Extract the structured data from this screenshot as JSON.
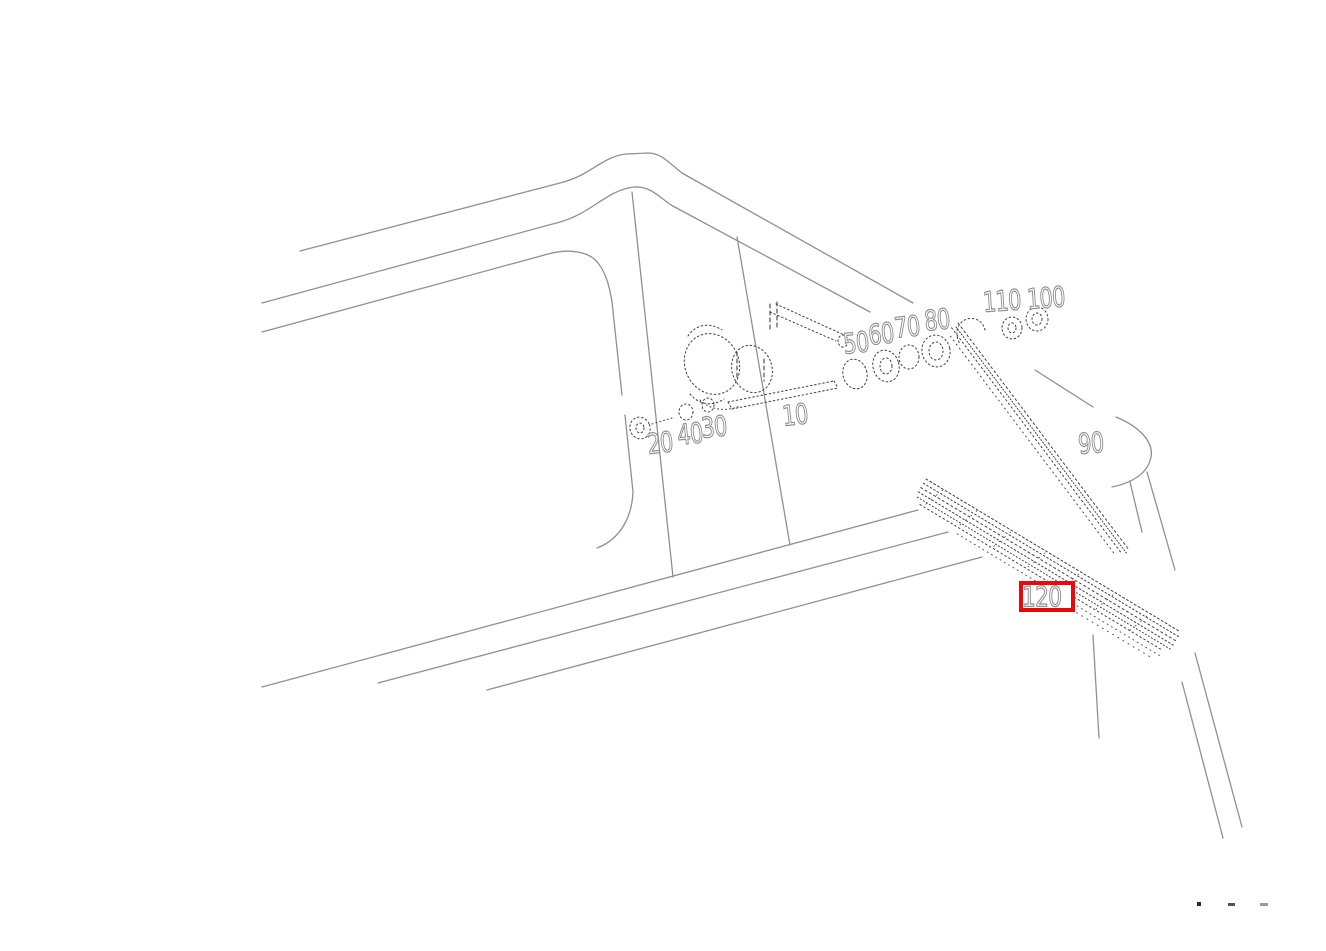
{
  "diagram": {
    "description": "vehicle windshield wiper system exploded parts diagram",
    "background": "#ffffff"
  },
  "colors": {
    "body_line": "#909090",
    "part_line": "#3f3f3f",
    "label_outline": "#8c8c8c",
    "label_fill": "#ffffff",
    "highlight_red": "#ee0707"
  },
  "part_labels": [
    {
      "text": "20",
      "x": 646,
      "y": 431,
      "rot": -6
    },
    {
      "text": "40",
      "x": 676,
      "y": 422,
      "rot": -6
    },
    {
      "text": "30",
      "x": 700,
      "y": 415,
      "rot": -6
    },
    {
      "text": "10",
      "x": 781,
      "y": 403,
      "rot": -6
    },
    {
      "text": "50",
      "x": 842,
      "y": 331,
      "rot": -6
    },
    {
      "text": "60",
      "x": 867,
      "y": 322,
      "rot": -6
    },
    {
      "text": "70",
      "x": 893,
      "y": 315,
      "rot": -6
    },
    {
      "text": "80",
      "x": 923,
      "y": 308,
      "rot": -6
    },
    {
      "text": "110",
      "x": 982,
      "y": 289,
      "rot": -4
    },
    {
      "text": "100",
      "x": 1026,
      "y": 286,
      "rot": -4
    },
    {
      "text": "90",
      "x": 1077,
      "y": 431,
      "rot": -5
    }
  ],
  "highlight": {
    "text": "120",
    "x": 1019,
    "y": 581,
    "width": 56,
    "height": 31
  },
  "artifact_marks": [
    {
      "x": 1197,
      "y": 902,
      "w": 4,
      "h": 4,
      "color": "#2a2a2a"
    },
    {
      "x": 1228,
      "y": 903,
      "w": 7,
      "h": 3,
      "color": "#555555"
    },
    {
      "x": 1260,
      "y": 903,
      "w": 8,
      "h": 3,
      "color": "#9a9a9a"
    }
  ]
}
